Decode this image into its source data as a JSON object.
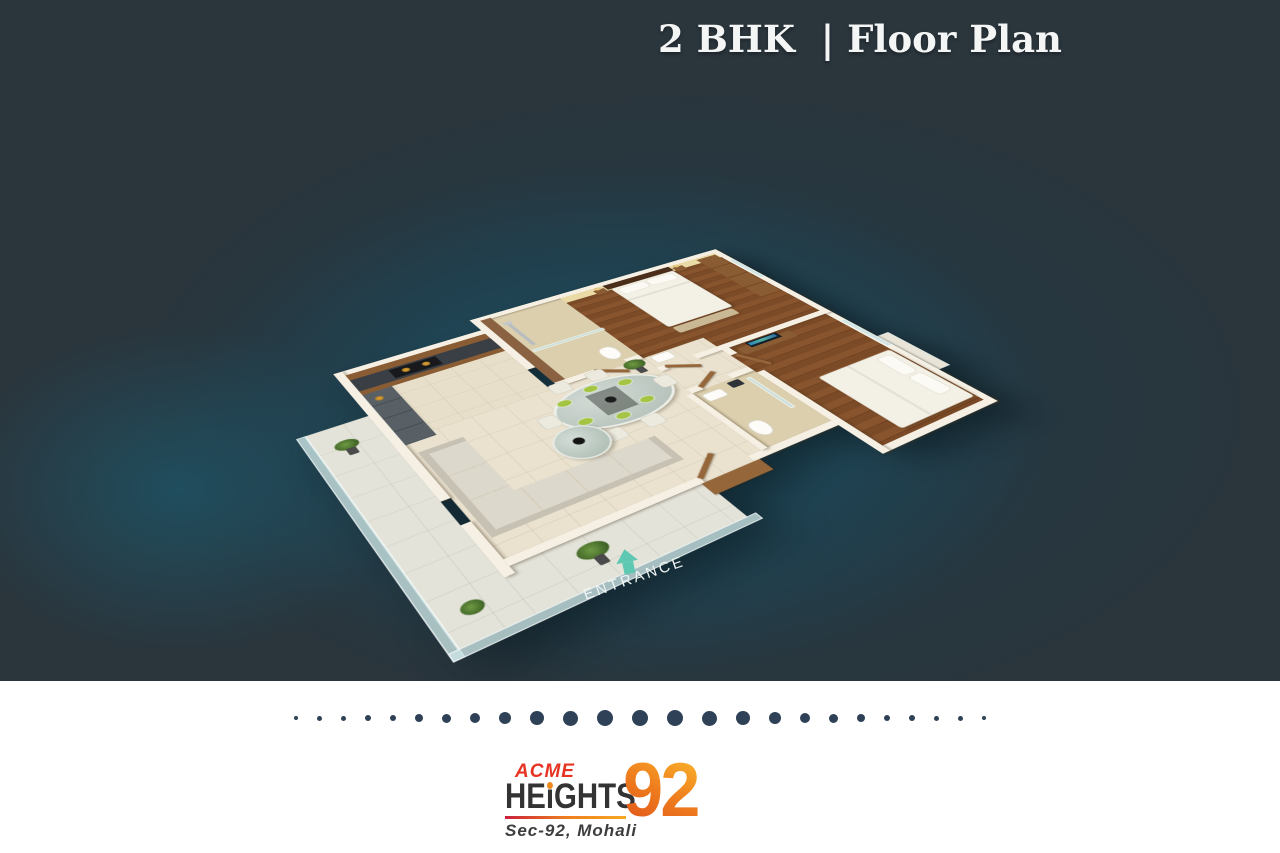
{
  "header": {
    "title": "2 BHK  | Floor Plan"
  },
  "plan": {
    "entrance_label": "ENTRANCE"
  },
  "divider": {
    "dot_count": 25,
    "dot_color": "#2e4156"
  },
  "logo": {
    "acme": "ACME",
    "heights_he": "HE",
    "heights_i": "ı",
    "heights_ghts": "GHTS",
    "number": "92",
    "subtitle": "Sec-92, Mohali"
  },
  "colors": {
    "background_slate": "#2a353c",
    "teal_glow": "#1f5066",
    "entrance_mint": "#5fc8b2",
    "title_white": "#f4f6f6",
    "dot_navy": "#2e4156",
    "acme_red": "#e63322",
    "heights_dark": "#333333",
    "orange_accent": "#f08a1d",
    "number_gradient_start": "#f9b32a",
    "number_gradient_end": "#e05418",
    "underline_gradient_start": "#c9203c",
    "underline_gradient_end": "#f7a823"
  }
}
